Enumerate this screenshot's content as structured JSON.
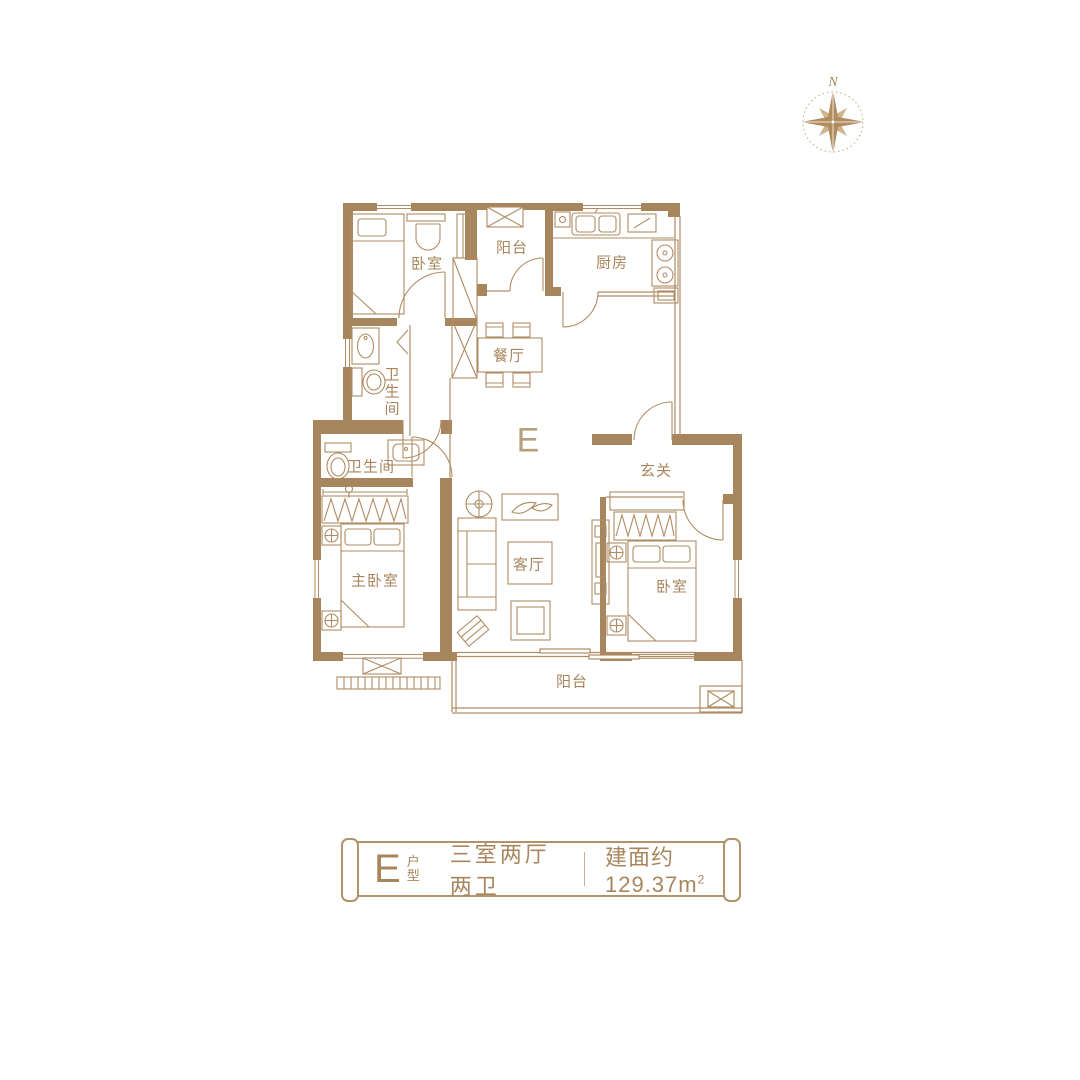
{
  "page": {
    "background": "#ffffff"
  },
  "colors": {
    "wall": "#a8865d",
    "furniture_line": "#af8c63",
    "text": "#a8865d",
    "compass_dark": "#b08c5f",
    "compass_light": "#cdb591"
  },
  "icons": {
    "compass": "compass-rose",
    "ac_unit": "crossed-box",
    "door": "quarter-arc",
    "wardrobe": "zigzag-hanger",
    "window": "triple-line"
  },
  "compass": {
    "north": "N"
  },
  "floor_plan": {
    "unit_label": "E",
    "rooms": {
      "bedroom_top": {
        "label": "卧室"
      },
      "balcony_top": {
        "label": "阳台"
      },
      "kitchen": {
        "label": "厨房"
      },
      "dining": {
        "label": "餐厅"
      },
      "bath_upper": {
        "label": "卫生间"
      },
      "bath_lower": {
        "label": "卫生间"
      },
      "master_bedroom": {
        "label": "主卧室"
      },
      "living": {
        "label": "客厅"
      },
      "entry": {
        "label": "玄关"
      },
      "bedroom_right": {
        "label": "卧室"
      },
      "balcony_bottom": {
        "label": "阳台"
      }
    }
  },
  "banner": {
    "unit": "E",
    "unit_suffix": "户型",
    "layout": "三室两厅两卫",
    "area_prefix": "建面约129.37m",
    "area_sup": "2"
  }
}
